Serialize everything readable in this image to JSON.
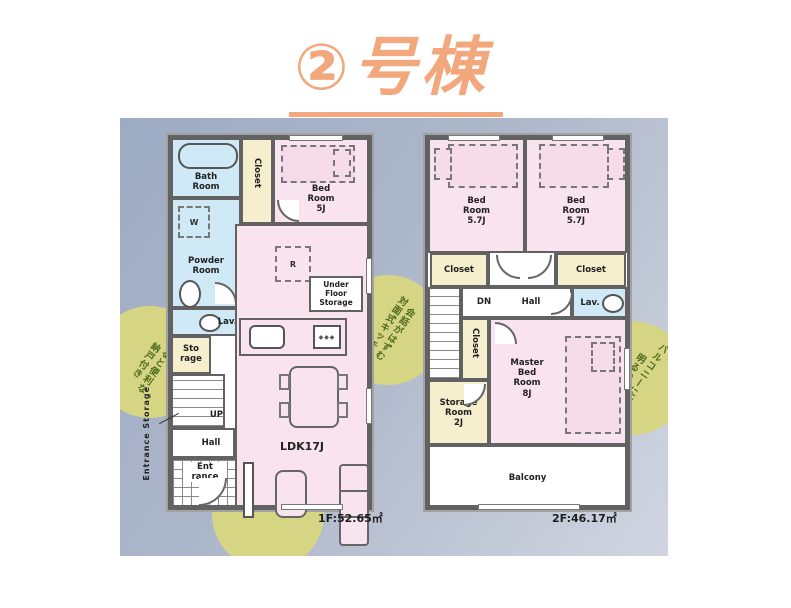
{
  "title": "②号棟",
  "floor1": {
    "area": "1F:52.65㎡",
    "labels": {
      "bath": "Bath\nRoom",
      "closet": "Closet",
      "bedroom": "Bed\nRoom\n5J",
      "washer": "W",
      "powder": "Powder\nRoom",
      "lav": "Lav.",
      "storage": "Sto\nrage",
      "up": "UP",
      "hall": "Hall",
      "entrance": "Ent\nrance",
      "entrance_storage": "Entrance Storage",
      "fridge": "R",
      "under_floor": "Under\nFloor\nStorage",
      "ldk": "LDK17J",
      "burners": "◆◆◆"
    }
  },
  "floor2": {
    "area": "2F:46.17㎡",
    "labels": {
      "bedroom_left": "Bed\nRoom\n5.7J",
      "bedroom_right": "Bed\nRoom\n5.7J",
      "closet_left": "Closet",
      "closet_right": "Closet",
      "dn": "DN",
      "hall": "Hall",
      "lav": "Lav.",
      "closet_mid": "Closet",
      "master": "Master\nBed\nRoom\n8J",
      "storage_room": "Storage\nRoom\n2J",
      "balcony": "Balcony"
    }
  },
  "badges": {
    "storage": "あると便利な\n納戸付き",
    "kitchen": "会話がはずむ\n対面式キッチン",
    "balcony": "バルコニーに面した\n明るい洋室",
    "living": "インテリアが\n映える広々とした\nリビング"
  },
  "colors": {
    "title_orange": "#f2a87c",
    "room_pink": "#f8e3ee",
    "room_blue": "#cfe9f6",
    "room_cream": "#f6efcd",
    "wall_gray": "#626262",
    "badge_yellow": "#d6d584",
    "badge_text_green": "#4c6b1e",
    "backdrop_top": "#9dabc4",
    "backdrop_bottom": "#d0d5e0"
  }
}
